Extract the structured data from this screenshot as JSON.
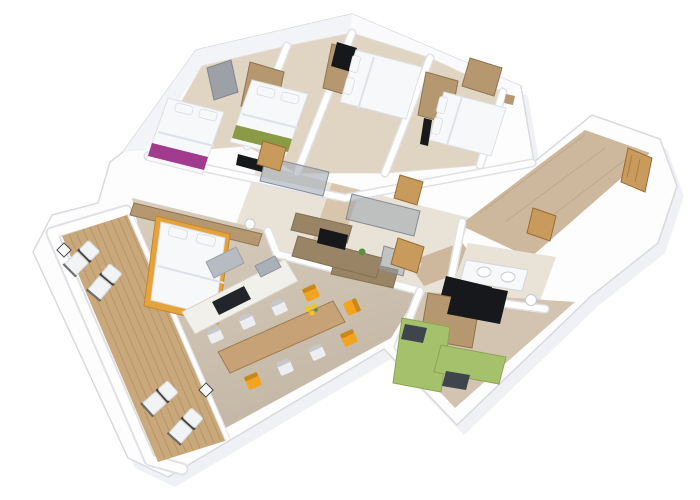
{
  "meta": {
    "type": "3d-apartment-floor-plan-render",
    "view": "rotated top-down axonometric cutaway, white background, no visible text"
  },
  "palette": {
    "background": "#ffffff",
    "wall_white": "#fdfdfe",
    "wall_line": "#d9dade",
    "attic_light": "#f3f4f7",
    "attic_lighter": "#fafafc",
    "shadow": "#edeff2",
    "floor_bedroom": "#e0d4c2",
    "floor_bath": "#e8e2d7",
    "floor_corridor": "#d8c5ab",
    "floor_living": "#cfc2b1",
    "floor_hall": "#cdb89d",
    "floor_se": "#d2c4b1",
    "deck_wood": "#c9a87c",
    "plank_dark": "#ac8a5e",
    "table_wood": "#c7a277",
    "table_edge": "#a27c4f",
    "chair_orange": "#f2a31f",
    "chair_white": "#eceef1",
    "island_white": "#f2f0ea",
    "oven_black": "#22252a",
    "hood_gray": "#b7bcc2",
    "sink_gray": "#a9b0b7",
    "bed_white": "#f7f8fa",
    "bed_line": "#dde2e8",
    "headboard_orange": "#e5a33c",
    "wood_furniture": "#b69870",
    "runner_purple": "#a23a8d",
    "runner_olive": "#8b9a44",
    "door_pine": "#c89a5b",
    "door_grain": "#9a6c33",
    "tv_black": "#16181b",
    "glass_gray": "#9aa2ab",
    "vanity_wood": "#9a8466",
    "sofa_green": "#a6c16c",
    "cushion_dark": "#3f454d",
    "window_gray": "#9ba1a6",
    "lounger_white": "#f2f3f5",
    "lounger_frame": "#3c3e42",
    "flower_yellow": "#f2c71d",
    "plant_green": "#5d8f3d",
    "toilet_white": "#ffffff"
  },
  "scene": {
    "terrace": {
      "label": "wooden deck terrace",
      "loungers": 4,
      "side_tables": 2
    },
    "bedrooms": [
      {
        "label": "bedroom 1",
        "accent": "purple runner",
        "furniture": [
          "double bed",
          "wardrobe",
          "roof window"
        ]
      },
      {
        "label": "bedroom 2",
        "accent": "olive runner",
        "furniture": [
          "double bed",
          "wardrobe",
          "wall tv"
        ]
      },
      {
        "label": "bedroom 3",
        "accent": "white",
        "furniture": [
          "double bed",
          "wardrobe",
          "dark cabinet"
        ]
      },
      {
        "label": "bedroom 4",
        "accent": "white",
        "furniture": [
          "double bed",
          "wardrobe",
          "nightstand",
          "wall tv"
        ]
      }
    ],
    "open_living_area": {
      "sleeping_nook": [
        "double bed with orange frame",
        "wardrobe sideboard"
      ],
      "kitchen": [
        "island counter",
        "black cooktop oven",
        "extractor hood",
        "sink"
      ],
      "dining": {
        "chairs_orange": 4,
        "chairs_white": 5,
        "decor": "yellow flowers on table"
      },
      "media": [
        "sideboard",
        "small tv",
        "plant",
        "glass partition"
      ]
    },
    "bathrooms": [
      {
        "label": "shower room 1",
        "furniture": [
          "glass shower wall",
          "vanity",
          "toilet",
          "pine door"
        ]
      },
      {
        "label": "shower room 2",
        "furniture": [
          "glass shower wall",
          "vanity",
          "toilet",
          "pine door"
        ]
      },
      {
        "label": "main bathroom",
        "furniture": [
          "double sink vanity",
          "dark mirror panel",
          "toilet"
        ]
      }
    ],
    "entry_hall": {
      "furniture": [
        "pine entry door",
        "interior pine doors",
        "wood plank floor"
      ]
    },
    "tv_room": {
      "furniture": [
        "green corner sofa",
        "dark cushions",
        "tv",
        "tv cabinet"
      ]
    }
  }
}
